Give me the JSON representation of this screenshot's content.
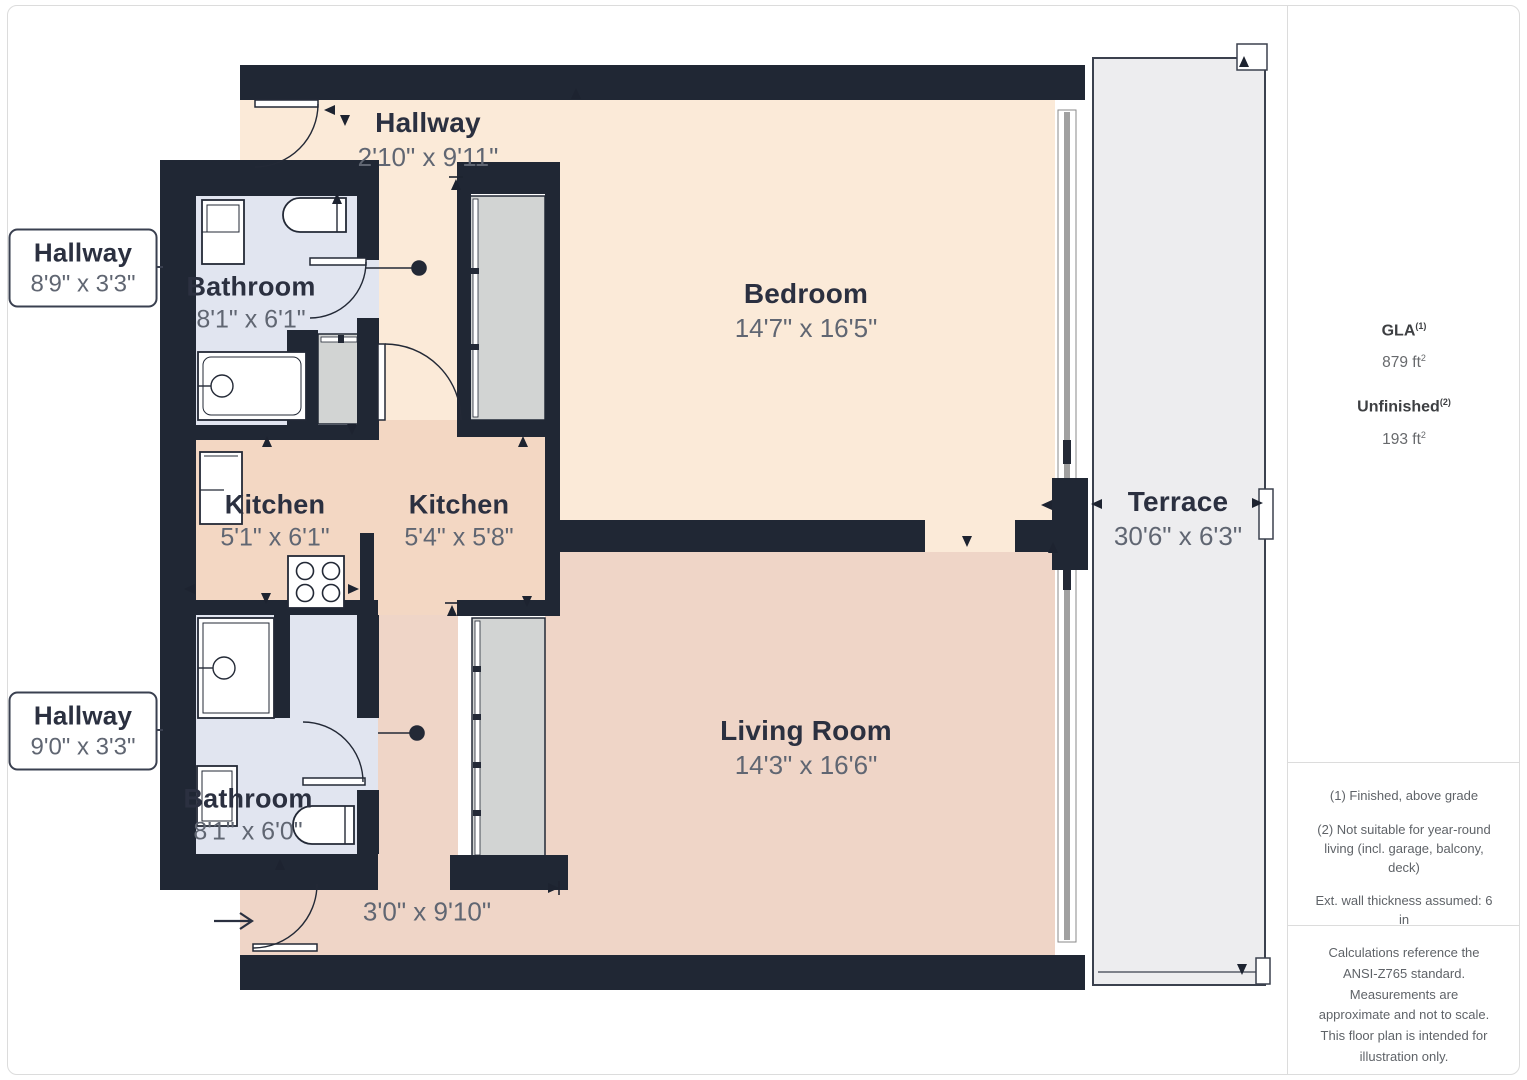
{
  "rooms": {
    "hallway_top": {
      "name": "Hallway",
      "dims": "2'10\" x 9'11\""
    },
    "bathroom_top": {
      "name": "Bathroom",
      "dims": "8'1\" x 6'1\""
    },
    "bedroom": {
      "name": "Bedroom",
      "dims": "14'7\" x 16'5\""
    },
    "kitchen_left": {
      "name": "Kitchen",
      "dims": "5'1\" x 6'1\""
    },
    "kitchen_center": {
      "name": "Kitchen",
      "dims": "5'4\" x 5'8\""
    },
    "bathroom_bottom": {
      "name": "Bathroom",
      "dims": "8'1\" x 6'0\""
    },
    "living_room": {
      "name": "Living Room",
      "dims": "14'3\" x 16'6\""
    },
    "terrace": {
      "name": "Terrace",
      "dims": "30'6\" x 6'3\""
    },
    "corridor": {
      "dims": "3'0\" x 9'10\""
    }
  },
  "callouts": {
    "hallway_upper": {
      "name": "Hallway",
      "dims": "8'9\" x 3'3\""
    },
    "hallway_lower": {
      "name": "Hallway",
      "dims": "9'0\" x 3'3\""
    }
  },
  "sidebar": {
    "gla_label": "GLA",
    "gla_sup": "(1)",
    "gla_value": "879 ft",
    "gla_value_sup": "2",
    "unfinished_label": "Unfinished",
    "unfinished_sup": "(2)",
    "unfinished_value": "193 ft",
    "unfinished_value_sup": "2",
    "notes": [
      "(1) Finished, above grade",
      "(2) Not suitable for year-round living (incl. garage, balcony, deck)",
      "Ext. wall thickness assumed: 6 in"
    ],
    "disclaimer": "Calculations reference the ANSI-Z765 standard. Measurements are approximate and not to scale. This floor plan is intended for illustration only."
  },
  "colors": {
    "wall": "#202734",
    "floor_warm": "#fbead8",
    "floor_pink": "#efd5c7",
    "floor_kitchen": "#f3d7c3",
    "floor_bathroom": "#e1e5f0",
    "closet_gray": "#d2d4d3",
    "terrace_gray": "#ededef",
    "window_gray": "#9b9b9b",
    "label_dark": "#2b3040",
    "label_gray": "#606672"
  }
}
